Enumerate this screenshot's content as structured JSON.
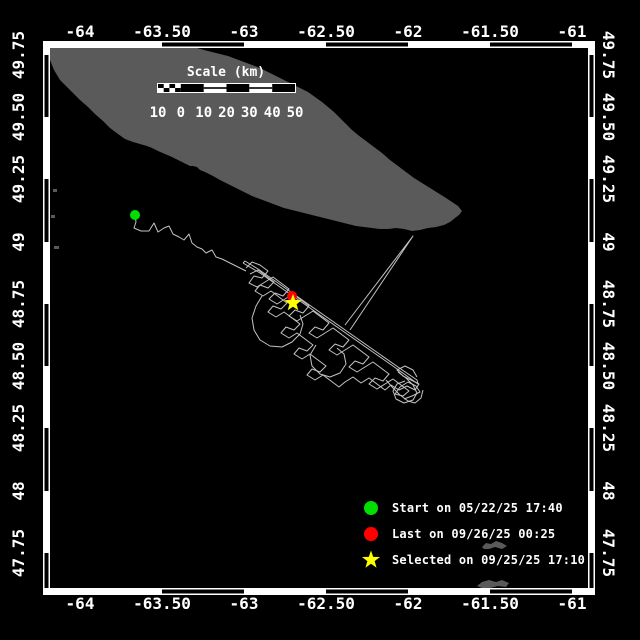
{
  "colors": {
    "background": "#000000",
    "frame": "#ffffff",
    "text": "#ffffff",
    "land": "#5a5a5a",
    "track": "#c3c3c3",
    "start": "#00df00",
    "last": "#ff0000",
    "selected": "#ffff00"
  },
  "axes": {
    "x": {
      "labels": [
        "-64",
        "-63.50",
        "-63",
        "-62.50",
        "-62",
        "-61.50",
        "-61"
      ],
      "px": [
        80,
        162,
        244,
        326,
        408,
        490,
        572
      ]
    },
    "y": {
      "labels": [
        "49.75",
        "49.50",
        "49.25",
        "49",
        "48.75",
        "48.50",
        "48.25",
        "48",
        "47.75"
      ],
      "px": [
        55,
        117,
        179,
        242,
        304,
        366,
        428,
        491,
        553
      ]
    }
  },
  "frame": {
    "outer": [
      43,
      41,
      595,
      595
    ],
    "inner": [
      50,
      48,
      588,
      588
    ],
    "top_black_segments": [
      [
        162,
        244
      ],
      [
        326,
        408
      ],
      [
        490,
        572
      ]
    ],
    "side_black_segments": [
      [
        55,
        117
      ],
      [
        179,
        242
      ],
      [
        304,
        366
      ],
      [
        428,
        491
      ],
      [
        553,
        588
      ]
    ]
  },
  "scalebar": {
    "title": "Scale (km)",
    "labels": [
      "10",
      "0",
      "10",
      "20",
      "30",
      "40",
      "50"
    ],
    "boundaries_px": [
      158,
      180.8,
      203.7,
      226.5,
      249.3,
      272.2,
      295
    ],
    "bar_y": 84,
    "bar_h": 8,
    "title_pos": [
      226,
      76
    ],
    "labels_y": 117
  },
  "land": {
    "main_polygon": [
      [
        50,
        48
      ],
      [
        197,
        48
      ],
      [
        204,
        50
      ],
      [
        212,
        52
      ],
      [
        220,
        54
      ],
      [
        228,
        56
      ],
      [
        236,
        59
      ],
      [
        244,
        62
      ],
      [
        252,
        65
      ],
      [
        260,
        68
      ],
      [
        268,
        72
      ],
      [
        276,
        76
      ],
      [
        284,
        80
      ],
      [
        292,
        84
      ],
      [
        300,
        88
      ],
      [
        308,
        92
      ],
      [
        315,
        97
      ],
      [
        322,
        102
      ],
      [
        328,
        107
      ],
      [
        334,
        112
      ],
      [
        340,
        118
      ],
      [
        346,
        124
      ],
      [
        352,
        130
      ],
      [
        358,
        135
      ],
      [
        366,
        141
      ],
      [
        374,
        147
      ],
      [
        382,
        153
      ],
      [
        390,
        160
      ],
      [
        398,
        166
      ],
      [
        406,
        172
      ],
      [
        414,
        178
      ],
      [
        422,
        183
      ],
      [
        430,
        188
      ],
      [
        438,
        193
      ],
      [
        446,
        198
      ],
      [
        452,
        202
      ],
      [
        458,
        206
      ],
      [
        462,
        211
      ],
      [
        459,
        215
      ],
      [
        455,
        218
      ],
      [
        450,
        222
      ],
      [
        444,
        225
      ],
      [
        436,
        227
      ],
      [
        428,
        228
      ],
      [
        420,
        230
      ],
      [
        412,
        231
      ],
      [
        404,
        229
      ],
      [
        396,
        228
      ],
      [
        388,
        229
      ],
      [
        380,
        229
      ],
      [
        372,
        228
      ],
      [
        364,
        227
      ],
      [
        356,
        226
      ],
      [
        348,
        224
      ],
      [
        340,
        222
      ],
      [
        332,
        220
      ],
      [
        324,
        218
      ],
      [
        316,
        216
      ],
      [
        308,
        214
      ],
      [
        300,
        212
      ],
      [
        292,
        210
      ],
      [
        284,
        208
      ],
      [
        276,
        205
      ],
      [
        268,
        202
      ],
      [
        260,
        199
      ],
      [
        252,
        196
      ],
      [
        244,
        192
      ],
      [
        236,
        188
      ],
      [
        228,
        184
      ],
      [
        220,
        180
      ],
      [
        213,
        176
      ],
      [
        205,
        172
      ],
      [
        200,
        170
      ],
      [
        197,
        167
      ],
      [
        193,
        166
      ],
      [
        190,
        166
      ],
      [
        184,
        163
      ],
      [
        178,
        160
      ],
      [
        172,
        157
      ],
      [
        165,
        154
      ],
      [
        158,
        151
      ],
      [
        152,
        148
      ],
      [
        147,
        146
      ],
      [
        140,
        144
      ],
      [
        133,
        142
      ],
      [
        125,
        139
      ],
      [
        118,
        134
      ],
      [
        110,
        128
      ],
      [
        103,
        121
      ],
      [
        95,
        114
      ],
      [
        88,
        107
      ],
      [
        80,
        100
      ],
      [
        73,
        93
      ],
      [
        66,
        86
      ],
      [
        60,
        80
      ],
      [
        54,
        70
      ],
      [
        50,
        60
      ]
    ],
    "islands": [
      [
        [
          482,
          547
        ],
        [
          486,
          543
        ],
        [
          491,
          544
        ],
        [
          496,
          541
        ],
        [
          502,
          543
        ],
        [
          507,
          546
        ],
        [
          502,
          549
        ],
        [
          495,
          547
        ],
        [
          489,
          549
        ],
        [
          484,
          549
        ]
      ],
      [
        [
          477,
          586
        ],
        [
          482,
          582
        ],
        [
          489,
          580
        ],
        [
          496,
          582
        ],
        [
          502,
          580
        ],
        [
          509,
          583
        ],
        [
          506,
          587
        ],
        [
          498,
          586
        ],
        [
          490,
          588
        ],
        [
          482,
          588
        ]
      ]
    ],
    "specks": [
      [
        53,
        189,
        4,
        3
      ],
      [
        51,
        215,
        4,
        3
      ],
      [
        54,
        246,
        5,
        3
      ]
    ]
  },
  "track": {
    "lines": [
      [
        [
          135,
          215
        ],
        [
          136,
          222
        ],
        [
          134,
          228
        ],
        [
          141,
          231
        ],
        [
          149,
          231
        ],
        [
          154,
          223
        ],
        [
          158,
          232
        ],
        [
          164,
          228
        ],
        [
          169,
          226
        ],
        [
          173,
          234
        ],
        [
          179,
          237
        ],
        [
          184,
          240
        ],
        [
          189,
          234
        ],
        [
          192,
          243
        ],
        [
          197,
          247
        ],
        [
          202,
          249
        ],
        [
          206,
          253
        ],
        [
          212,
          250
        ],
        [
          216,
          257
        ],
        [
          222,
          259
        ],
        [
          228,
          262
        ],
        [
          234,
          265
        ],
        [
          240,
          268
        ],
        [
          246,
          271
        ]
      ],
      [
        [
          246,
          268
        ],
        [
          252,
          262
        ],
        [
          260,
          265
        ],
        [
          268,
          271
        ],
        [
          262,
          278
        ],
        [
          254,
          276
        ],
        [
          249,
          283
        ],
        [
          257,
          287
        ],
        [
          265,
          282
        ],
        [
          273,
          277
        ],
        [
          281,
          283
        ],
        [
          289,
          289
        ],
        [
          283,
          296
        ],
        [
          275,
          293
        ],
        [
          269,
          299
        ],
        [
          277,
          304
        ],
        [
          285,
          299
        ],
        [
          293,
          294
        ],
        [
          301,
          300
        ],
        [
          309,
          306
        ],
        [
          303,
          313
        ],
        [
          295,
          310
        ],
        [
          289,
          316
        ],
        [
          297,
          321
        ],
        [
          305,
          316
        ],
        [
          313,
          311
        ],
        [
          321,
          317
        ],
        [
          329,
          323
        ],
        [
          323,
          330
        ],
        [
          315,
          327
        ],
        [
          309,
          333
        ],
        [
          317,
          338
        ],
        [
          325,
          333
        ],
        [
          333,
          328
        ],
        [
          341,
          334
        ],
        [
          349,
          340
        ],
        [
          343,
          347
        ],
        [
          335,
          344
        ],
        [
          329,
          350
        ],
        [
          337,
          355
        ],
        [
          345,
          350
        ],
        [
          353,
          345
        ],
        [
          361,
          351
        ],
        [
          369,
          357
        ],
        [
          363,
          364
        ],
        [
          355,
          361
        ],
        [
          349,
          367
        ],
        [
          357,
          372
        ],
        [
          365,
          367
        ],
        [
          373,
          362
        ],
        [
          381,
          368
        ],
        [
          389,
          374
        ],
        [
          383,
          381
        ],
        [
          375,
          378
        ],
        [
          369,
          384
        ],
        [
          377,
          389
        ],
        [
          385,
          384
        ],
        [
          393,
          379
        ],
        [
          401,
          385
        ],
        [
          409,
          391
        ],
        [
          403,
          396
        ],
        [
          395,
          394
        ],
        [
          400,
          387
        ],
        [
          408,
          382
        ],
        [
          416,
          386
        ],
        [
          420,
          392
        ],
        [
          412,
          396
        ],
        [
          404,
          399
        ]
      ],
      [
        [
          250,
          274
        ],
        [
          258,
          270
        ],
        [
          266,
          276
        ],
        [
          274,
          282
        ],
        [
          268,
          288
        ],
        [
          260,
          285
        ],
        [
          255,
          291
        ],
        [
          263,
          296
        ],
        [
          271,
          291
        ],
        [
          279,
          297
        ],
        [
          287,
          303
        ],
        [
          281,
          309
        ],
        [
          273,
          306
        ],
        [
          268,
          312
        ],
        [
          276,
          317
        ],
        [
          284,
          312
        ],
        [
          292,
          318
        ],
        [
          300,
          324
        ],
        [
          294,
          330
        ],
        [
          286,
          327
        ],
        [
          281,
          333
        ],
        [
          289,
          338
        ],
        [
          297,
          333
        ],
        [
          305,
          339
        ],
        [
          313,
          345
        ],
        [
          307,
          351
        ],
        [
          299,
          348
        ],
        [
          294,
          354
        ],
        [
          302,
          359
        ],
        [
          310,
          354
        ],
        [
          318,
          360
        ],
        [
          326,
          366
        ],
        [
          320,
          372
        ],
        [
          312,
          369
        ],
        [
          307,
          375
        ],
        [
          315,
          380
        ],
        [
          323,
          375
        ],
        [
          331,
          381
        ],
        [
          339,
          387
        ],
        [
          345,
          382
        ],
        [
          353,
          377
        ],
        [
          361,
          383
        ],
        [
          369,
          378
        ],
        [
          377,
          384
        ],
        [
          385,
          390
        ],
        [
          391,
          385
        ],
        [
          399,
          390
        ],
        [
          407,
          386
        ],
        [
          415,
          390
        ],
        [
          419,
          384
        ],
        [
          411,
          380
        ],
        [
          403,
          376
        ],
        [
          397,
          370
        ],
        [
          405,
          366
        ],
        [
          413,
          370
        ],
        [
          417,
          377
        ]
      ],
      [
        [
          243,
          263
        ],
        [
          260,
          273
        ],
        [
          280,
          287
        ],
        [
          300,
          301
        ],
        [
          320,
          315
        ],
        [
          340,
          329
        ],
        [
          360,
          343
        ],
        [
          380,
          357
        ],
        [
          400,
          371
        ],
        [
          418,
          384
        ],
        [
          417,
          380
        ],
        [
          398,
          367
        ],
        [
          378,
          353
        ],
        [
          358,
          339
        ],
        [
          338,
          325
        ],
        [
          318,
          311
        ],
        [
          298,
          297
        ],
        [
          278,
          283
        ],
        [
          258,
          269
        ],
        [
          245,
          261
        ],
        [
          243,
          263
        ]
      ],
      [
        [
          262,
          296
        ],
        [
          256,
          306
        ],
        [
          252,
          318
        ],
        [
          254,
          330
        ],
        [
          260,
          340
        ],
        [
          270,
          346
        ],
        [
          282,
          347
        ],
        [
          292,
          342
        ],
        [
          300,
          334
        ],
        [
          303,
          324
        ],
        [
          300,
          315
        ]
      ],
      [
        [
          316,
          345
        ],
        [
          310,
          355
        ],
        [
          312,
          366
        ],
        [
          320,
          374
        ],
        [
          330,
          377
        ],
        [
          340,
          373
        ],
        [
          346,
          364
        ],
        [
          344,
          354
        ],
        [
          337,
          348
        ]
      ],
      [
        [
          398,
          372
        ],
        [
          406,
          378
        ],
        [
          413,
          385
        ],
        [
          417,
          393
        ],
        [
          413,
          400
        ],
        [
          404,
          403
        ],
        [
          396,
          399
        ],
        [
          393,
          391
        ],
        [
          397,
          384
        ],
        [
          405,
          381
        ]
      ],
      [
        [
          386,
          380
        ],
        [
          393,
          388
        ],
        [
          400,
          395
        ],
        [
          408,
          401
        ],
        [
          415,
          403
        ],
        [
          421,
          398
        ],
        [
          423,
          390
        ]
      ],
      [
        [
          345,
          325
        ],
        [
          413,
          236
        ],
        [
          350,
          330
        ]
      ]
    ]
  },
  "markers": {
    "start": {
      "x": 135,
      "y": 215,
      "r": 5
    },
    "last": {
      "x": 292,
      "y": 296,
      "r": 5
    },
    "selected": {
      "x": 293,
      "y": 303,
      "r": 9
    }
  },
  "legend": {
    "rows_top": [
      499,
      525,
      551
    ],
    "items": [
      {
        "marker": "circle",
        "color_key": "start",
        "label": "Start on 05/22/25 17:40"
      },
      {
        "marker": "circle",
        "color_key": "last",
        "label": "Last on 09/26/25 00:25"
      },
      {
        "marker": "star",
        "color_key": "selected",
        "label": "Selected on 09/25/25 17:10"
      }
    ]
  }
}
